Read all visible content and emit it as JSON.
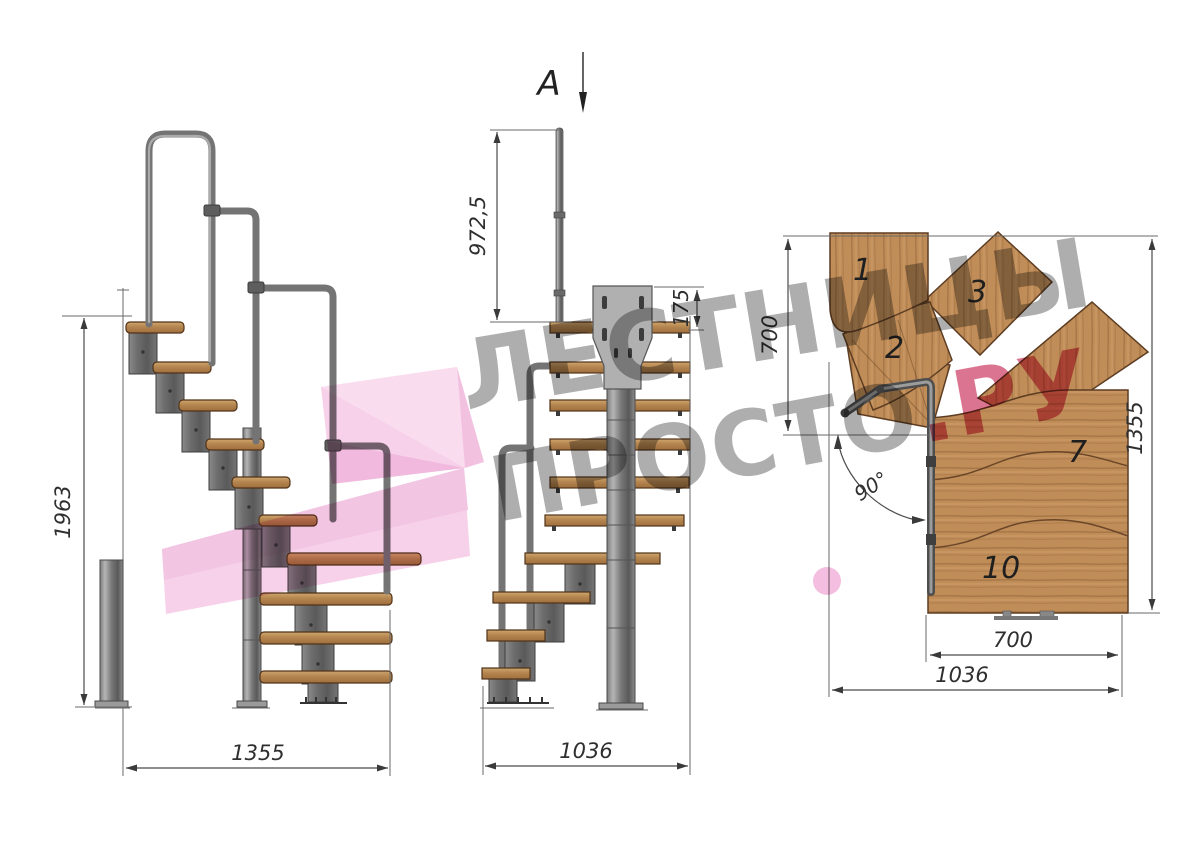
{
  "page": {
    "background": "#ffffff"
  },
  "drawing": {
    "section_marker": {
      "label": "A"
    },
    "side_view": {
      "name": "side-elevation",
      "total_height": "1963",
      "total_length": "1355"
    },
    "front_view": {
      "name": "front-section",
      "handrail_post_height": "972,5",
      "mount_plate_height": "175",
      "total_width": "1036"
    },
    "plan_view": {
      "name": "top-plan",
      "entry_flight_width": "700",
      "plan_depth": "1355",
      "exit_flight_width": "700",
      "plan_width": "1036",
      "turn_angle": "90°",
      "step_labels": {
        "s1": "1",
        "s2": "2",
        "s3": "3",
        "s7": "7",
        "s10": "10"
      }
    }
  },
  "watermark": {
    "line1": "ЛЕСТНИЦЫ",
    "line2": "ПРОСТО",
    "suffix": ".РУ"
  },
  "colors": {
    "wood": "#c08d58",
    "metal": "#8a8a8a",
    "dimension": "#3f3f3f",
    "watermark_gray": "#979797",
    "watermark_pink": "#d14d70",
    "logo_pink": "#f5c6e5"
  }
}
